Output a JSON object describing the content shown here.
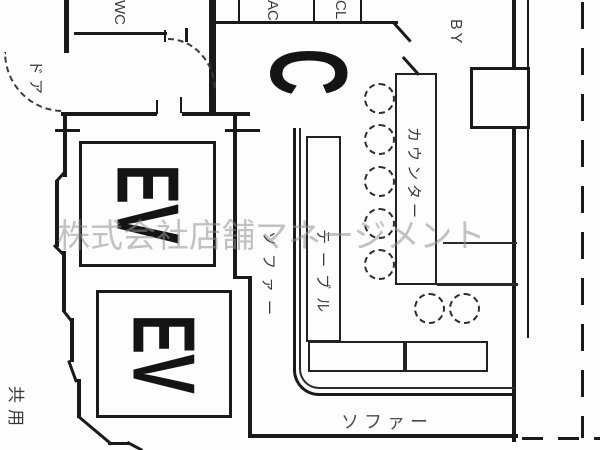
{
  "plan": {
    "watermark": "株式会社店舗マネージメント",
    "labels": {
      "wc": "WC",
      "ac": "AC",
      "cl": "CL",
      "balcony": "BY",
      "door": "ドア",
      "zone": "C",
      "elevator_upper": "EV",
      "elevator_lower": "EV",
      "counter": "カウンター",
      "table": "テーブル",
      "sofa_side": "ソファー",
      "sofa_bottom": "ソファー",
      "common_area": "共用"
    },
    "furniture": {
      "counter_stools": 5,
      "floor_stools": 2,
      "table_blocks": 3,
      "elevators": 2
    },
    "colors": {
      "line": "#1a1a1a",
      "label": "#3a3a3a",
      "watermark": "#919191",
      "background": "#fdfdfd"
    }
  }
}
